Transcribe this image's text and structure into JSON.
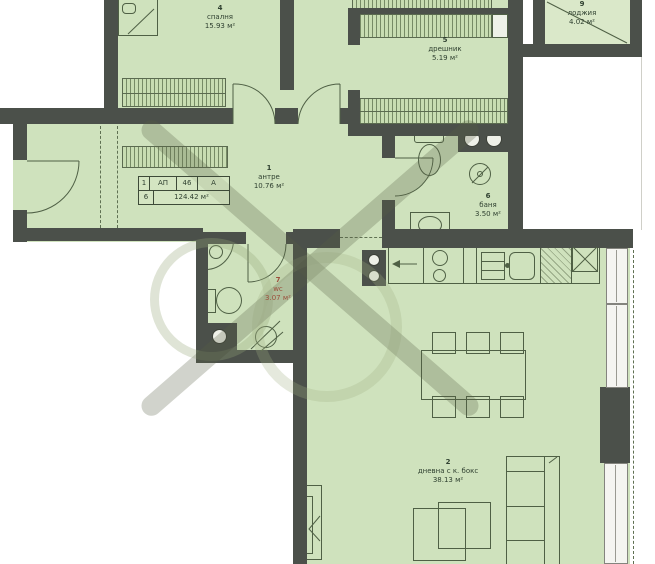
{
  "plan": {
    "title": "apartment floor plan",
    "info_table": {
      "r1": [
        "1",
        "АП",
        "46",
        "А"
      ],
      "r2": [
        "6",
        "124.42 м²"
      ]
    },
    "rooms": {
      "hallway": {
        "number": "1",
        "name": "антре",
        "area": "10.76 м²"
      },
      "living": {
        "number": "2",
        "name": "дневна с к. бокс",
        "area": "38.13 м²"
      },
      "bedroom": {
        "number": "4",
        "name": "спалня",
        "area": "15.93 м²"
      },
      "closet": {
        "number": "5",
        "name": "дрешник",
        "area": "5.19 м²"
      },
      "bathroom": {
        "number": "6",
        "name": "баня",
        "area": "3.50 м²"
      },
      "wc": {
        "number": "7",
        "name": "wc",
        "area": "3.07 м²"
      },
      "loggia": {
        "number": "9",
        "name": "лоджия",
        "area": "4.02 м²"
      }
    },
    "colors": {
      "room_fill": "#cfe2bd",
      "wall": "#4b504a",
      "linework": "#4f6045",
      "wc_label": "#9c4f3c",
      "watermark": "#585f44"
    }
  }
}
